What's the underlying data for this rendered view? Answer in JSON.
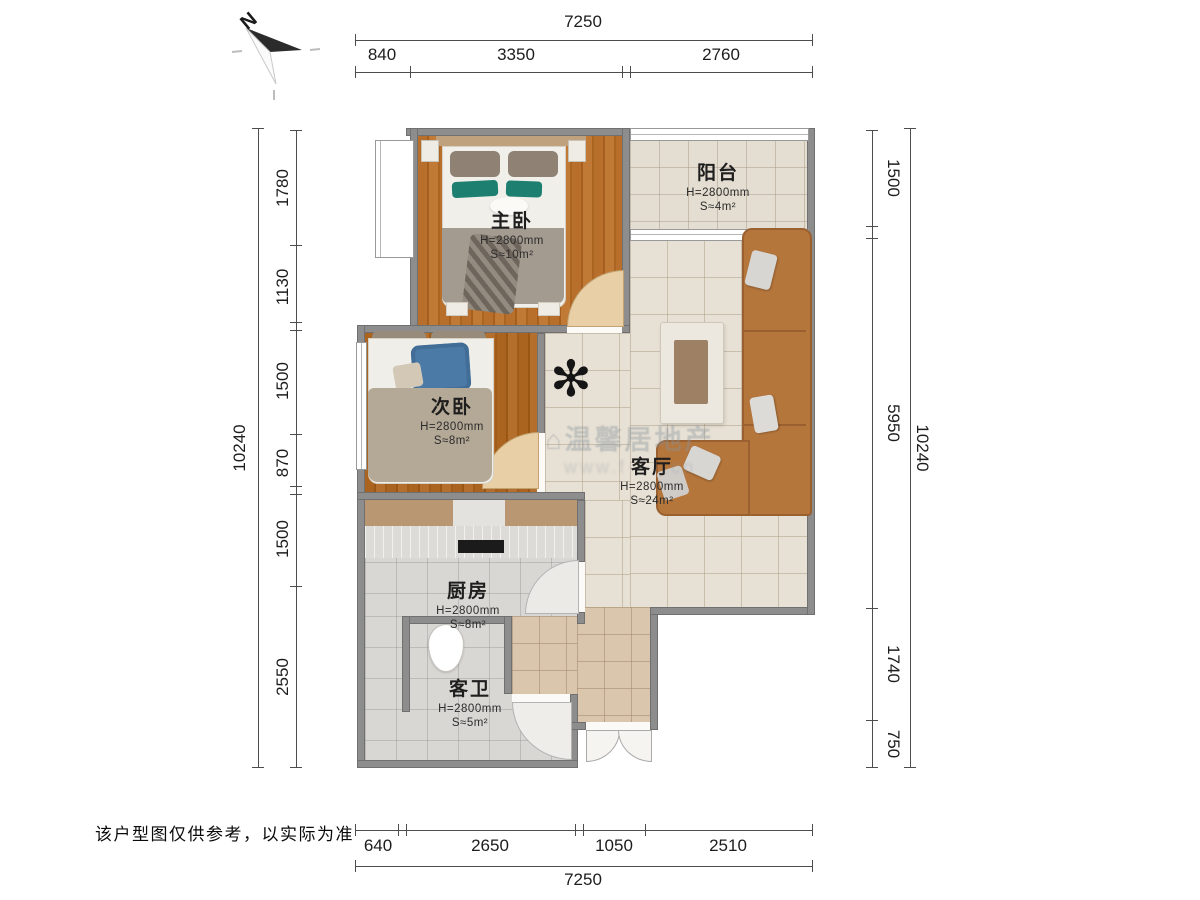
{
  "compass": {
    "north_label": "N"
  },
  "plan": {
    "rooms": [
      {
        "id": "master",
        "name": "主卧",
        "height": "H=2800mm",
        "area": "S≈10m²"
      },
      {
        "id": "balcony",
        "name": "阳台",
        "height": "H=2800mm",
        "area": "S≈4m²"
      },
      {
        "id": "second",
        "name": "次卧",
        "height": "H=2800mm",
        "area": "S≈8m²"
      },
      {
        "id": "living",
        "name": "客厅",
        "height": "H=2800mm",
        "area": "S≈24m²"
      },
      {
        "id": "kitchen",
        "name": "厨房",
        "height": "H=2800mm",
        "area": "S≈8m²"
      },
      {
        "id": "bath",
        "name": "客卫",
        "height": "H=2800mm",
        "area": "S≈5m²"
      }
    ]
  },
  "dimensions": {
    "top": {
      "total": "7250",
      "segments": [
        "840",
        "3350",
        "2760"
      ]
    },
    "bottom": {
      "total": "7250",
      "segments": [
        "640",
        "2650",
        "1050",
        "2510"
      ]
    },
    "left": {
      "total": "10240",
      "segments": [
        "1780",
        "1130",
        "1500",
        "870",
        "1500",
        "2550"
      ]
    },
    "right": {
      "total": "10240",
      "segments": [
        "1500",
        "5950",
        "1740",
        "750"
      ]
    }
  },
  "watermark": {
    "icon": "⌂",
    "line1": "温馨居地产",
    "line2": "www.f····.cn"
  },
  "disclaimer": "该户型图仅供参考，以实际为准",
  "colors": {
    "wall": "#8d8d8d",
    "wood": "#b76f2b",
    "tile": "#e7e0d4",
    "sofa": "#b5763c",
    "accent_teal": "#1d7f70"
  }
}
